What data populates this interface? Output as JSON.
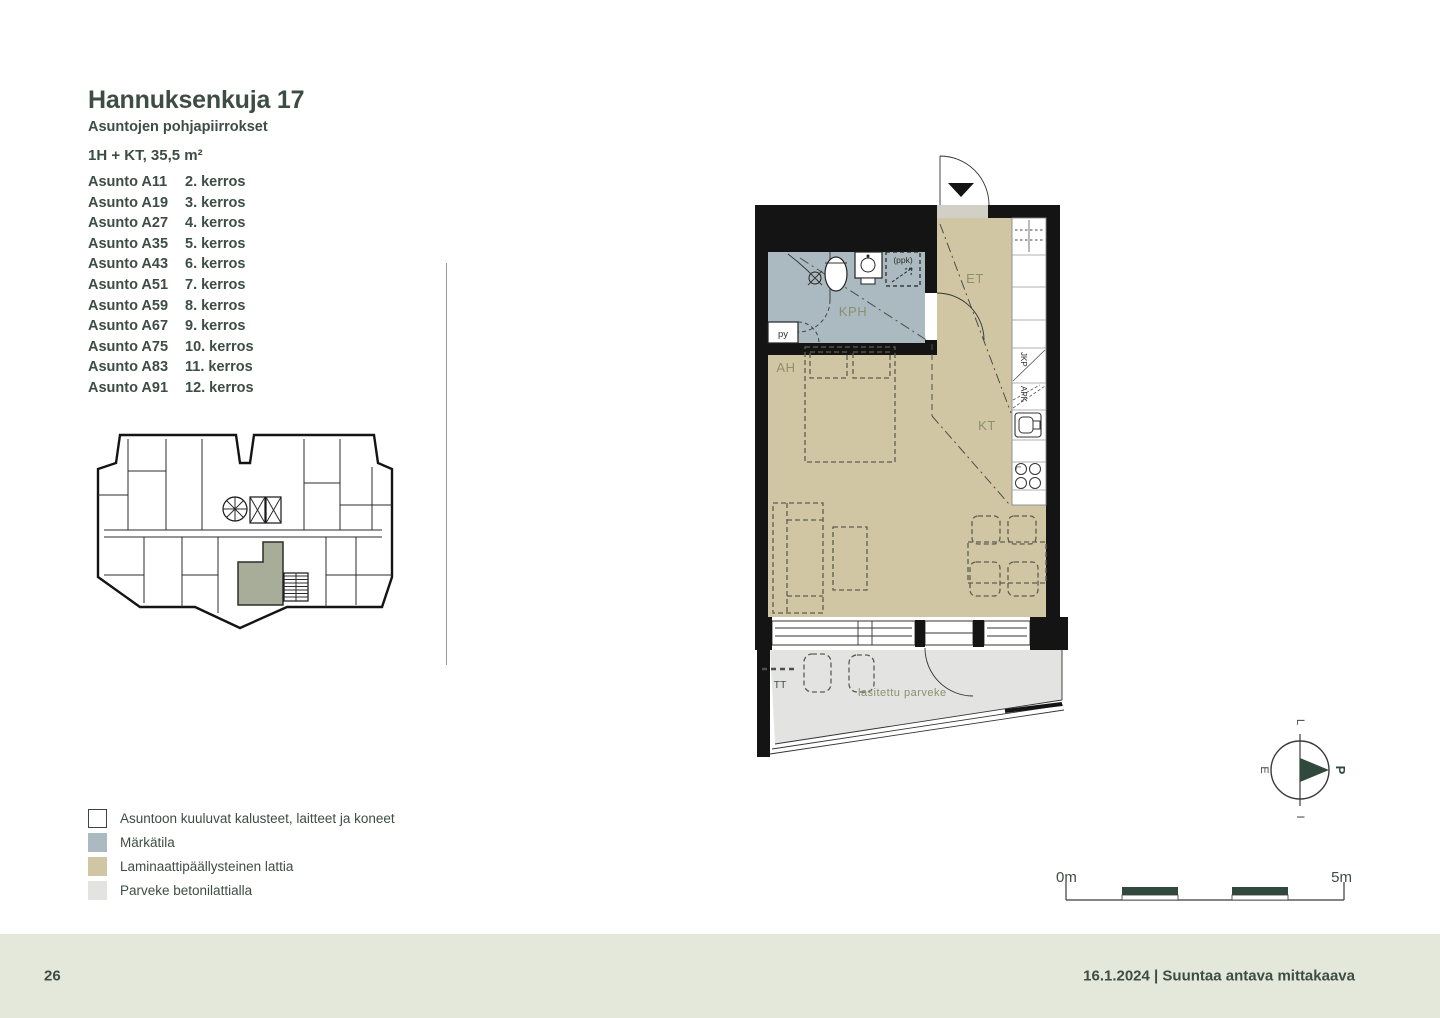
{
  "header": {
    "title": "Hannuksenkuja 17",
    "subtitle": "Asuntojen pohjapiirrokset",
    "apartment_type": "1H + KT, 35,5 m²"
  },
  "apartments": [
    {
      "name": "Asunto A11",
      "floor": "2. kerros"
    },
    {
      "name": "Asunto A19",
      "floor": "3. kerros"
    },
    {
      "name": "Asunto A27",
      "floor": "4. kerros"
    },
    {
      "name": "Asunto A35",
      "floor": "5. kerros"
    },
    {
      "name": "Asunto A43",
      "floor": "6. kerros"
    },
    {
      "name": "Asunto A51",
      "floor": "7. kerros"
    },
    {
      "name": "Asunto A59",
      "floor": "8. kerros"
    },
    {
      "name": "Asunto A67",
      "floor": "9. kerros"
    },
    {
      "name": "Asunto A75",
      "floor": "10. kerros"
    },
    {
      "name": "Asunto A83",
      "floor": "11. kerros"
    },
    {
      "name": "Asunto A91",
      "floor": "12. kerros"
    }
  ],
  "legend": [
    {
      "label": "Asuntoon kuuluvat kalusteet, laitteet ja koneet",
      "color": "#ffffff",
      "border": "#3a463e"
    },
    {
      "label": "Märkätila",
      "color": "#abbac0"
    },
    {
      "label": "Laminaattipäällysteinen lattia",
      "color": "#d1c6a4"
    },
    {
      "label": "Parveke betonilattialla",
      "color": "#e3e3e1"
    }
  ],
  "floorplan": {
    "labels": {
      "kph": "KPH",
      "et": "ET",
      "ah": "AH",
      "kt": "KT",
      "tt": "TT",
      "py": "py",
      "ppk": "(ppk)",
      "jkp": "JKP",
      "apk": "APK",
      "stove": "L",
      "balcony": "lasitettu parveke"
    }
  },
  "compass": {
    "north": "P",
    "south": "E",
    "east": "I",
    "west": "L"
  },
  "scale": {
    "start": "0m",
    "end": "5m"
  },
  "footer": {
    "page_number": "26",
    "note": "16.1.2024 | Suuntaa antava mittakaava"
  },
  "colors": {
    "ink": "#3e4d44",
    "label": "#8a9170",
    "tan": "#d1c6a4",
    "wet": "#abbac0",
    "balc": "#e3e3e1",
    "hl": "#a7ad98",
    "footer": "#e4e8db",
    "deep": "#31493c",
    "wall": "#141414",
    "furn": "#5d5e52"
  }
}
